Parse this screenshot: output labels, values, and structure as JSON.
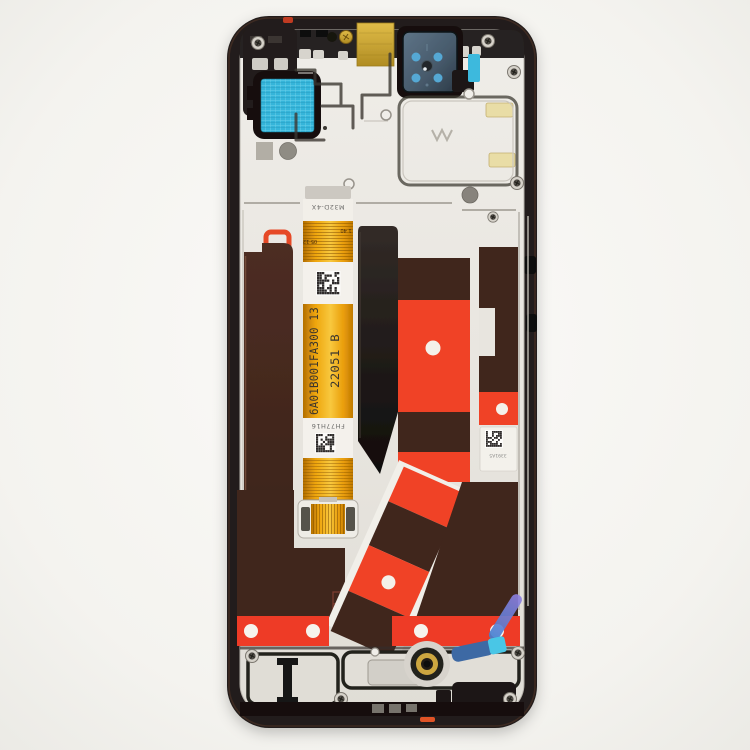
{
  "scene": {
    "title": "Smartphone LCD screen assembly with frame, back view - replacement spare part product photo",
    "background": "#f5f4f1"
  },
  "markings": {
    "cable_serial": "6A01B001FA300 13",
    "cable_batch": "22051 B",
    "cable_top_label": "M32D-4X",
    "cable_bottom_label": "FH77H16",
    "pin_mark_left": "05 12",
    "pin_mark_right": "1 40",
    "adhesive_label": "3391A5"
  },
  "colors": {
    "frame_black": "#221c1a",
    "plate_silver": "#e9e6e0",
    "cable_orange": "#efa30d",
    "adhesive_red": "#f04326",
    "strip_red": "#ee3b25",
    "graphite_maroon": "#40261e",
    "mesh_cyan": "#3cb9dd",
    "pad_gold": "#cfa733",
    "camera_dot_blue": "#55a8d4",
    "adhesive_yellow": "#e9dda6",
    "flex_blue": "#3e69a4",
    "flex_cyan": "#48c6e6",
    "tab_violet": "#7f6fd0"
  }
}
